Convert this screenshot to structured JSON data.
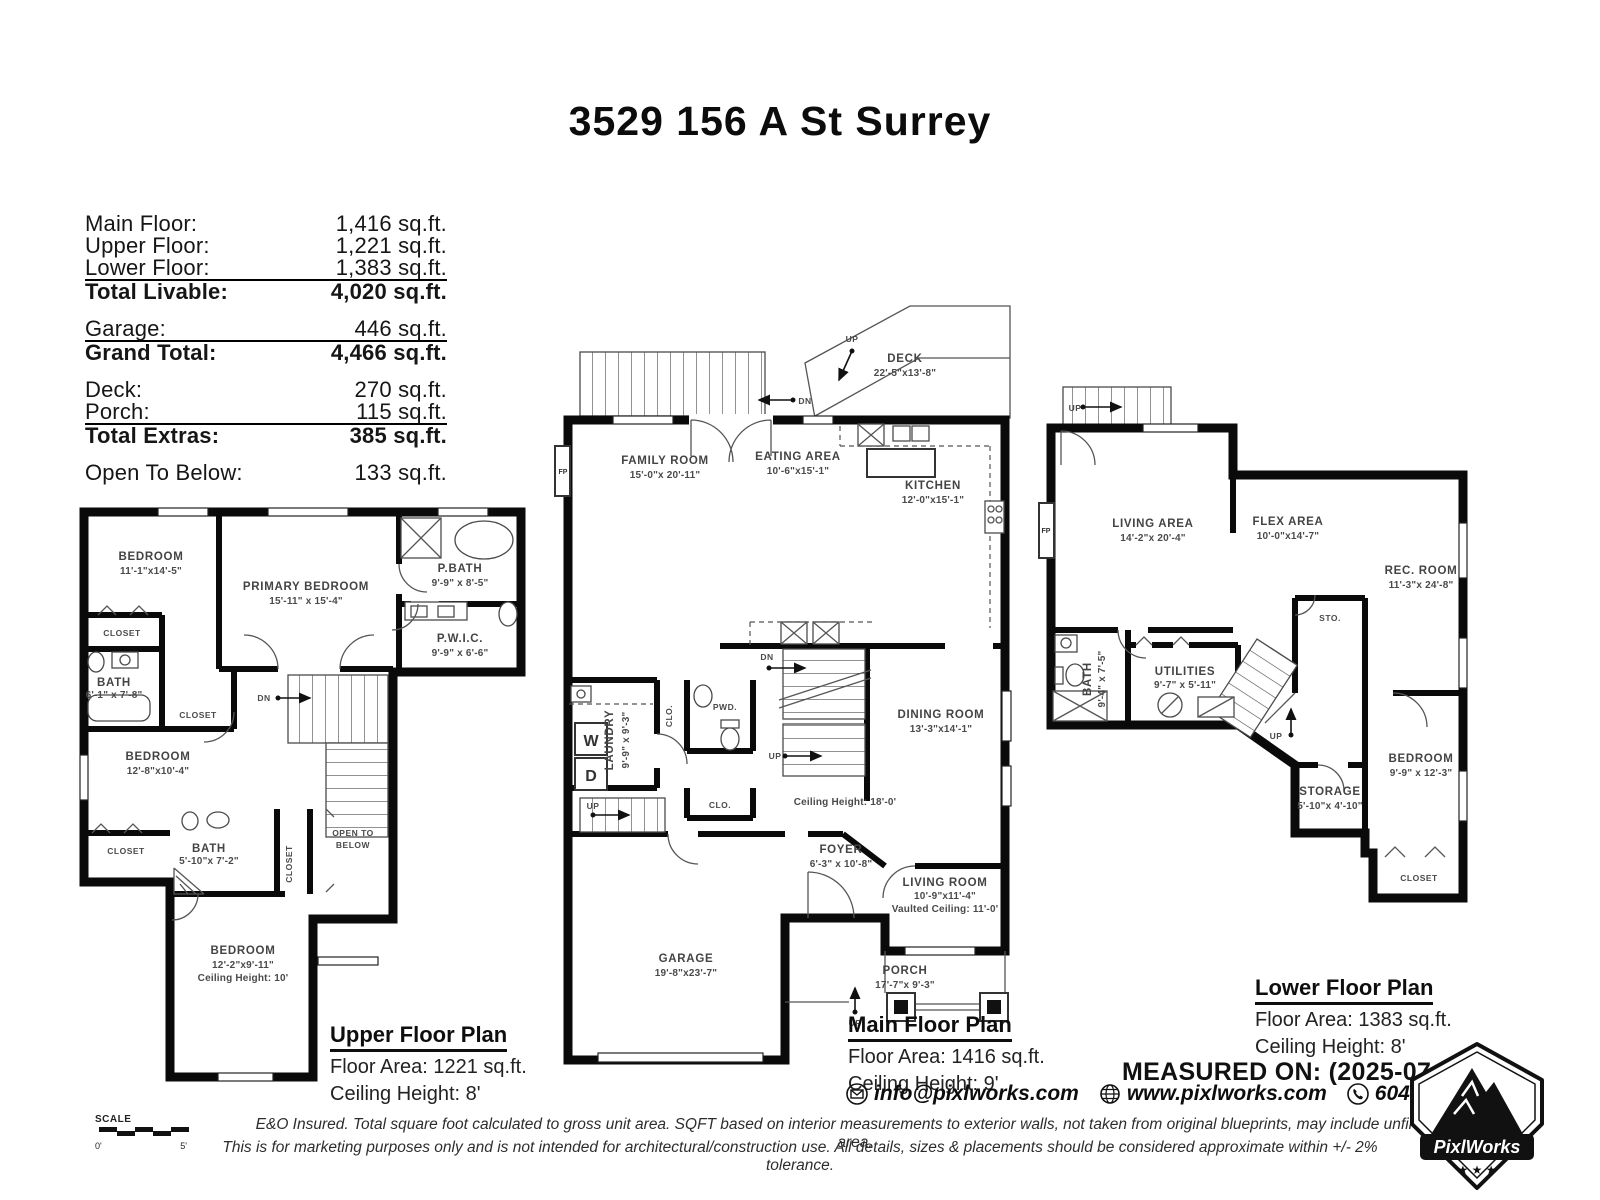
{
  "title": "3529 156 A St Surrey",
  "summary": {
    "rows": [
      {
        "label": "Main Floor:",
        "value": "1,416 sq.ft."
      },
      {
        "label": "Upper Floor:",
        "value": "1,221 sq.ft."
      },
      {
        "label": "Lower Floor:",
        "value": "1,383 sq.ft."
      },
      {
        "label": "Total Livable:",
        "value": "4,020 sq.ft."
      },
      {
        "label": "Garage:",
        "value": "446 sq.ft."
      },
      {
        "label": "Grand Total:",
        "value": "4,466 sq.ft."
      },
      {
        "label": "Deck:",
        "value": "270 sq.ft."
      },
      {
        "label": "Porch:",
        "value": "115 sq.ft."
      },
      {
        "label": "Total Extras:",
        "value": "385 sq.ft."
      },
      {
        "label": "Open To Below:",
        "value": "133 sq.ft."
      }
    ]
  },
  "tokens": {
    "closet": "CLOSET",
    "clo": "CLO.",
    "dn": "DN",
    "up": "UP",
    "fp": "FP",
    "w": "W",
    "d": "D",
    "sto": "STO.",
    "pwd": "PWD.",
    "scale": "SCALE",
    "scale_zero": "0'",
    "scale_five": "5'"
  },
  "plans": {
    "upper": {
      "heading": "Upper Floor Plan",
      "floor_area": "Floor Area: 1221 sq.ft.",
      "ceiling": "Ceiling Height: 8'",
      "rooms": {
        "bedroom1": {
          "name": "BEDROOM",
          "dims": "11'-1\"x14'-5\""
        },
        "primary": {
          "name": "PRIMARY BEDROOM",
          "dims": "15'-11\" x 15'-4\""
        },
        "pbath": {
          "name": "P.BATH",
          "dims": "9'-9\" x 8'-5\""
        },
        "pwic": {
          "name": "P.W.I.C.",
          "dims": "9'-9\" x 6'-6\""
        },
        "bath1": {
          "name": "BATH",
          "dims": "6'-1\" x 7'-8\""
        },
        "bedroom2": {
          "name": "BEDROOM",
          "dims": "12'-8\"x10'-4\""
        },
        "bath2": {
          "name": "BATH",
          "dims": "5'-10\"x 7'-2\""
        },
        "open_to_below": {
          "line1": "OPEN TO",
          "line2": "BELOW"
        },
        "bedroom3": {
          "name": "BEDROOM",
          "dims": "12'-2\"x9'-11\"",
          "extra": "Ceiling Height: 10'"
        }
      }
    },
    "main": {
      "heading": "Main Floor Plan",
      "floor_area": "Floor Area: 1416 sq.ft.",
      "ceiling": "Ceiling Height: 9'",
      "rooms": {
        "deck": {
          "name": "DECK",
          "dims": "22'-5\"x13'-8\""
        },
        "family": {
          "name": "FAMILY ROOM",
          "dims": "15'-0\"x  20'-11\""
        },
        "eating": {
          "name": "EATING AREA",
          "dims": "10'-6\"x15'-1\""
        },
        "kitchen": {
          "name": "KITCHEN",
          "dims": "12'-0\"x15'-1\""
        },
        "laundry": {
          "name": "LAUNDRY",
          "dims": "9'-9\" x 9'-3\""
        },
        "dining": {
          "name": "DINING ROOM",
          "dims": "13'-3\"x14'-1\""
        },
        "ceiling_note": "Ceiling Height: 18'-0'",
        "foyer": {
          "name": "FOYER",
          "dims": "6'-3\" x 10'-8\""
        },
        "living": {
          "name": "LIVING ROOM",
          "dims": "10'-9\"x11'-4\"",
          "extra": "Vaulted Ceiling: 11'-0'"
        },
        "garage": {
          "name": "GARAGE",
          "dims": "19'-8\"x23'-7\""
        },
        "porch": {
          "name": "PORCH",
          "dims": "17'-7\"x 9'-3\""
        }
      }
    },
    "lower": {
      "heading": "Lower Floor Plan",
      "floor_area": "Floor Area: 1383 sq.ft.",
      "ceiling": "Ceiling Height: 8'",
      "rooms": {
        "living_area": {
          "name": "LIVING AREA",
          "dims": "14'-2\"x 20'-4\""
        },
        "flex": {
          "name": "FLEX AREA",
          "dims": "10'-0\"x14'-7\""
        },
        "rec": {
          "name": "REC. ROOM",
          "dims": "11'-3\"x 24'-8\""
        },
        "bath": {
          "name": "BATH",
          "dims": "9'-4\" x 7'-5\""
        },
        "utilities": {
          "name": "UTILITIES",
          "dims": "9'-7\" x 5'-11\""
        },
        "bedroom": {
          "name": "BEDROOM",
          "dims": "9'-9\" x 12'-3\""
        },
        "storage": {
          "name": "STORAGE",
          "dims": "5'-10\"x 4'-10\""
        }
      }
    }
  },
  "footer": {
    "measured_on": "MEASURED ON: (2025-07-25)",
    "email": "info@pixlworks.com",
    "website": "www.pixlworks.com",
    "phone": "604.329.5788",
    "logo_text": "PixlWorks",
    "disclaimer1": "E&O Insured.  Total square foot calculated to gross unit area. SQFT based on interior measurements to exterior walls, not taken from original blueprints, may include unfinished area.",
    "disclaimer2": "This is for marketing purposes only and is not intended for architectural/construction use.  All details, sizes & placements should be considered approximate within +/- 2%  tolerance."
  }
}
